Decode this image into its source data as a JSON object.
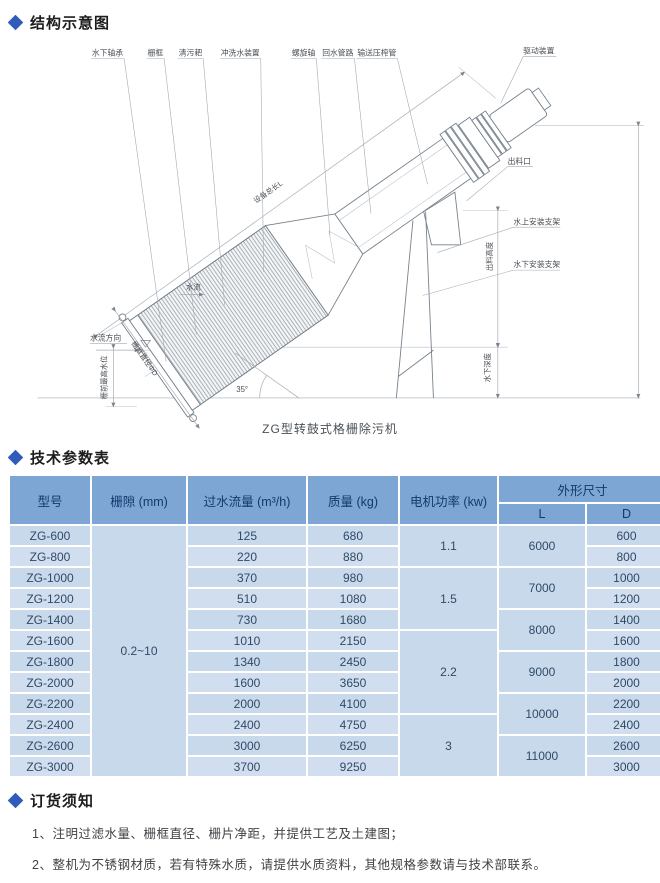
{
  "accent": {
    "diamond_color": "#2e5cb8",
    "table_header_bg": "#7da6d5",
    "table_cell_bg": "#c9d9ec"
  },
  "sections": {
    "structure": {
      "title": "结构示意图"
    },
    "params": {
      "title": "技术参数表"
    },
    "ordering": {
      "title": "订货须知"
    }
  },
  "diagram": {
    "caption": "ZG型转鼓式格栅除污机",
    "angle_label": "35°",
    "top_labels": [
      "水下轴承",
      "栅框",
      "清污耙",
      "冲洗水装置",
      "螺旋轴",
      "回水管路",
      "输送压榨管"
    ],
    "labels": {
      "drive": "驱动装置",
      "outlet": "出料口",
      "bracket_above": "水上安装支架",
      "bracket_below": "水下安装支架",
      "total_length": "设备总长L",
      "drum_diameter": "栅框直径ΦD",
      "discharge_height": "出料高度",
      "under_water_depth": "水下深度",
      "flow_direction": "水流方向",
      "max_water_level": "栅前最高水位",
      "inner_flow": "水流"
    }
  },
  "table": {
    "headers": {
      "model": "型号",
      "gap": "栅隙 (mm)",
      "flow": "过水流量 (m³/h)",
      "mass": "质量 (kg)",
      "motor": "电机功率 (kw)",
      "size": "外形尺寸",
      "L": "L",
      "D": "D"
    },
    "rows": [
      {
        "model": "ZG-600",
        "gap": {
          "v": "0.2~10",
          "span": 12
        },
        "flow": "125",
        "mass": "680",
        "motor": {
          "v": "1.1",
          "span": 2
        },
        "L": {
          "v": "6000",
          "span": 2
        },
        "D": "600"
      },
      {
        "model": "ZG-800",
        "flow": "220",
        "mass": "880",
        "D": "800"
      },
      {
        "model": "ZG-1000",
        "flow": "370",
        "mass": "980",
        "motor": {
          "v": "1.5",
          "span": 3
        },
        "L": {
          "v": "7000",
          "span": 2
        },
        "D": "1000"
      },
      {
        "model": "ZG-1200",
        "flow": "510",
        "mass": "1080",
        "D": "1200"
      },
      {
        "model": "ZG-1400",
        "flow": "730",
        "mass": "1680",
        "L": {
          "v": "8000",
          "span": 2
        },
        "D": "1400"
      },
      {
        "model": "ZG-1600",
        "flow": "1010",
        "mass": "2150",
        "motor": {
          "v": "2.2",
          "span": 4
        },
        "D": "1600"
      },
      {
        "model": "ZG-1800",
        "flow": "1340",
        "mass": "2450",
        "L": {
          "v": "9000",
          "span": 2
        },
        "D": "1800"
      },
      {
        "model": "ZG-2000",
        "flow": "1600",
        "mass": "3650",
        "D": "2000"
      },
      {
        "model": "ZG-2200",
        "flow": "2000",
        "mass": "4100",
        "L": {
          "v": "10000",
          "span": 2
        },
        "D": "2200"
      },
      {
        "model": "ZG-2400",
        "flow": "2400",
        "mass": "4750",
        "motor": {
          "v": "3",
          "span": 3
        },
        "D": "2400"
      },
      {
        "model": "ZG-2600",
        "flow": "3000",
        "mass": "6250",
        "L": {
          "v": "11000",
          "span": 2
        },
        "D": "2600"
      },
      {
        "model": "ZG-3000",
        "flow": "3700",
        "mass": "9250",
        "D": "3000"
      }
    ]
  },
  "notes": [
    "1、注明过滤水量、栅框直径、栅片净距，并提供工艺及土建图；",
    "2、整机为不锈钢材质，若有特殊水质，请提供水质资料，其他规格参数请与技术部联系。"
  ]
}
